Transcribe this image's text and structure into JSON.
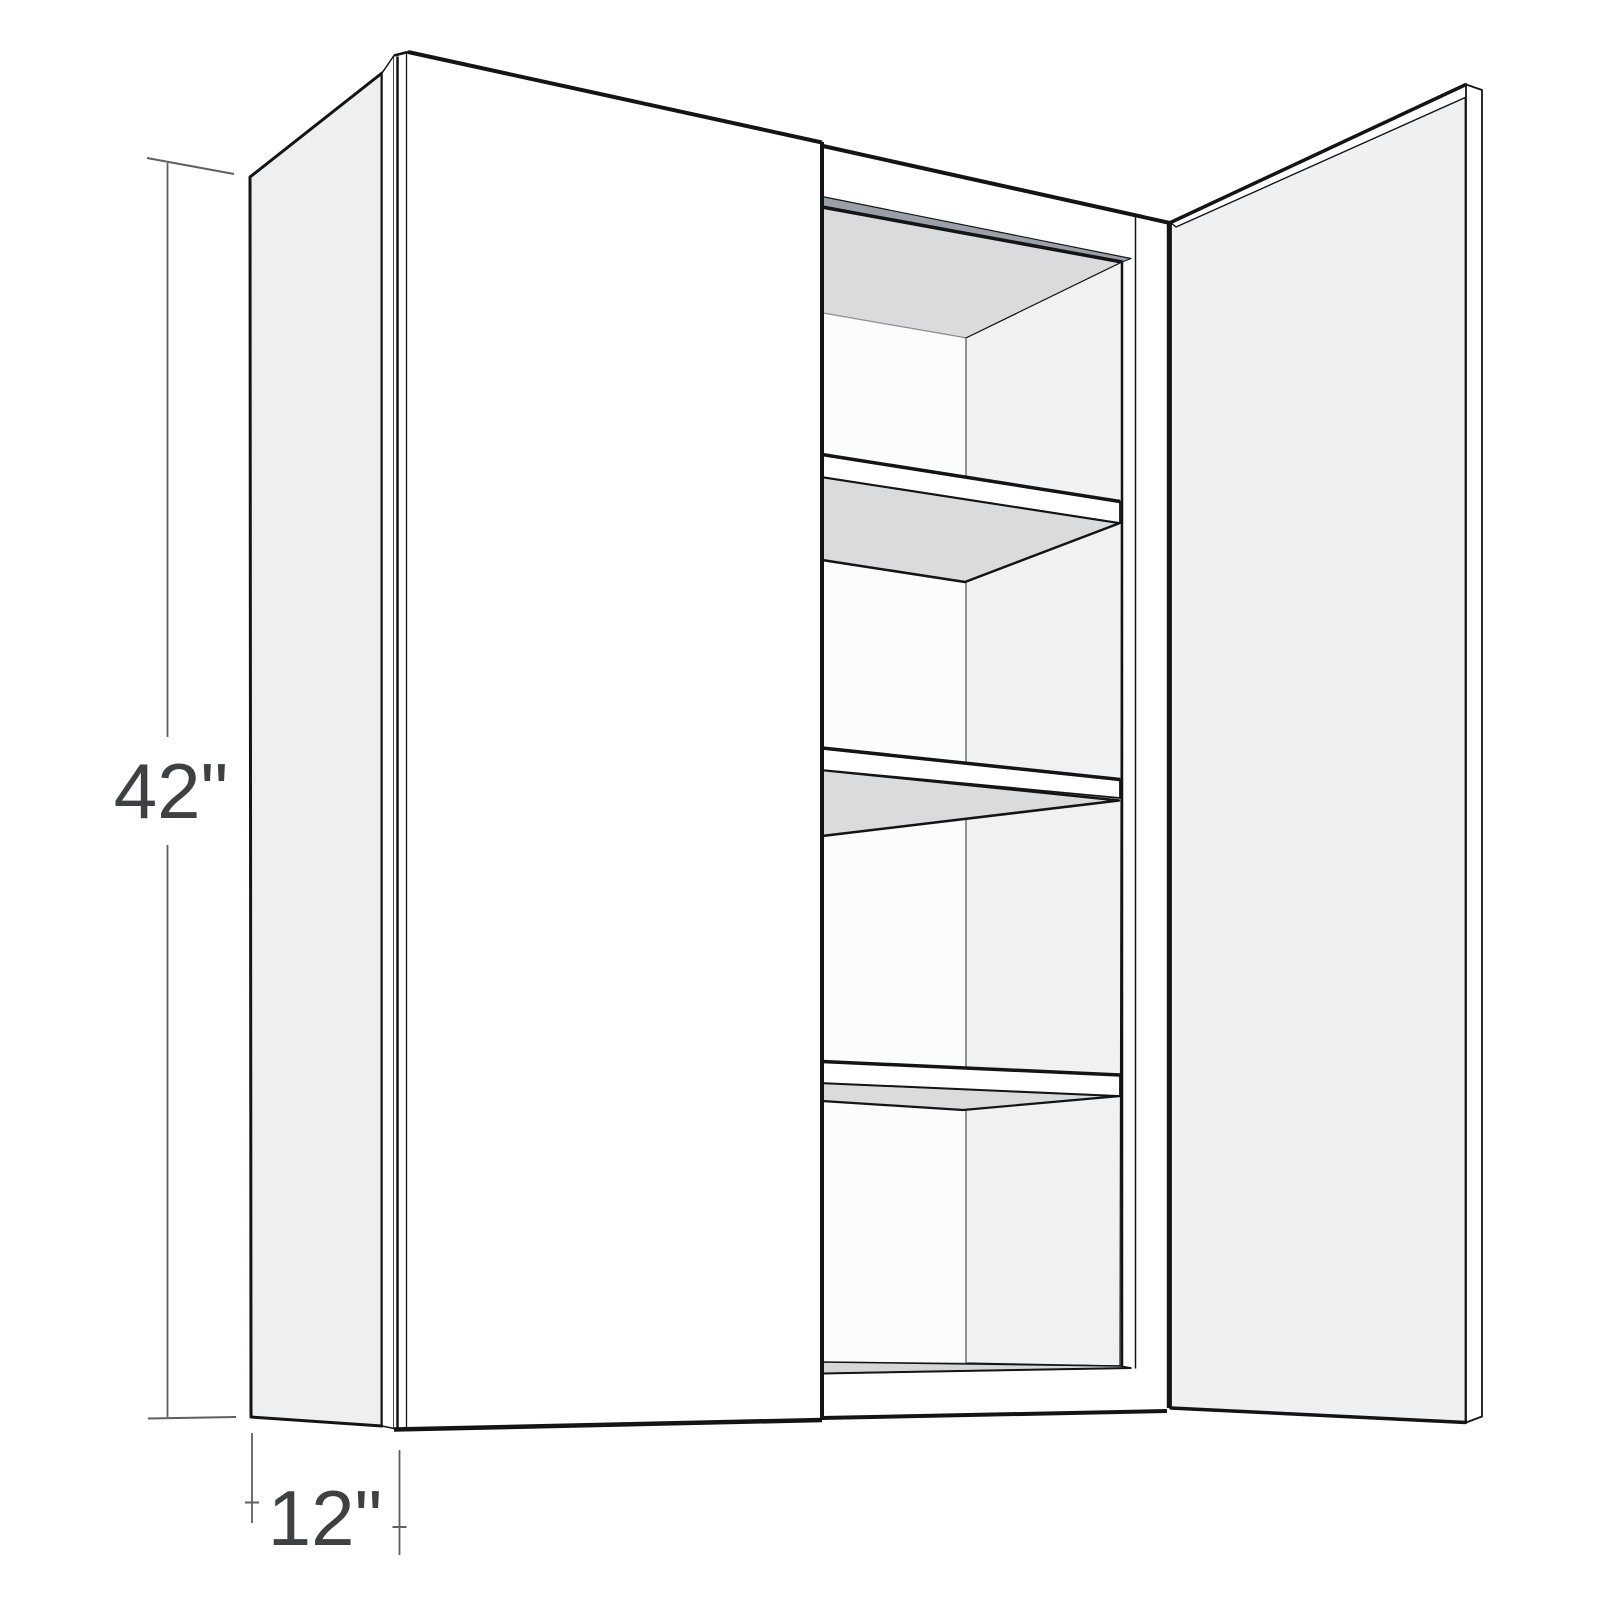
{
  "figure": {
    "description": "3D perspective line drawing of a two-door wall cabinet; left door closed, right door open revealing three interior shelves",
    "dimensions": {
      "height_label": "42\"",
      "depth_label": "12\""
    },
    "colors": {
      "background": "#ffffff",
      "outline": "#141414",
      "panel_gray": "#edeff0",
      "open_door_gray": "#eff0f1",
      "shelf_underside_gray": "#d9dbdc",
      "top_edge_strip": "#99a0a8",
      "floor_strip": "#d5d7d8",
      "interior_right_wall": "#eff1f2",
      "dimension_line": "#5f5f5f",
      "dimension_text": "#3e4042"
    },
    "parts": {
      "left_side_panel": "left side panel",
      "closed_left_door": "closed left door",
      "open_right_door": "open right door",
      "interior": "cabinet interior with three shelves and bottom panel"
    }
  }
}
